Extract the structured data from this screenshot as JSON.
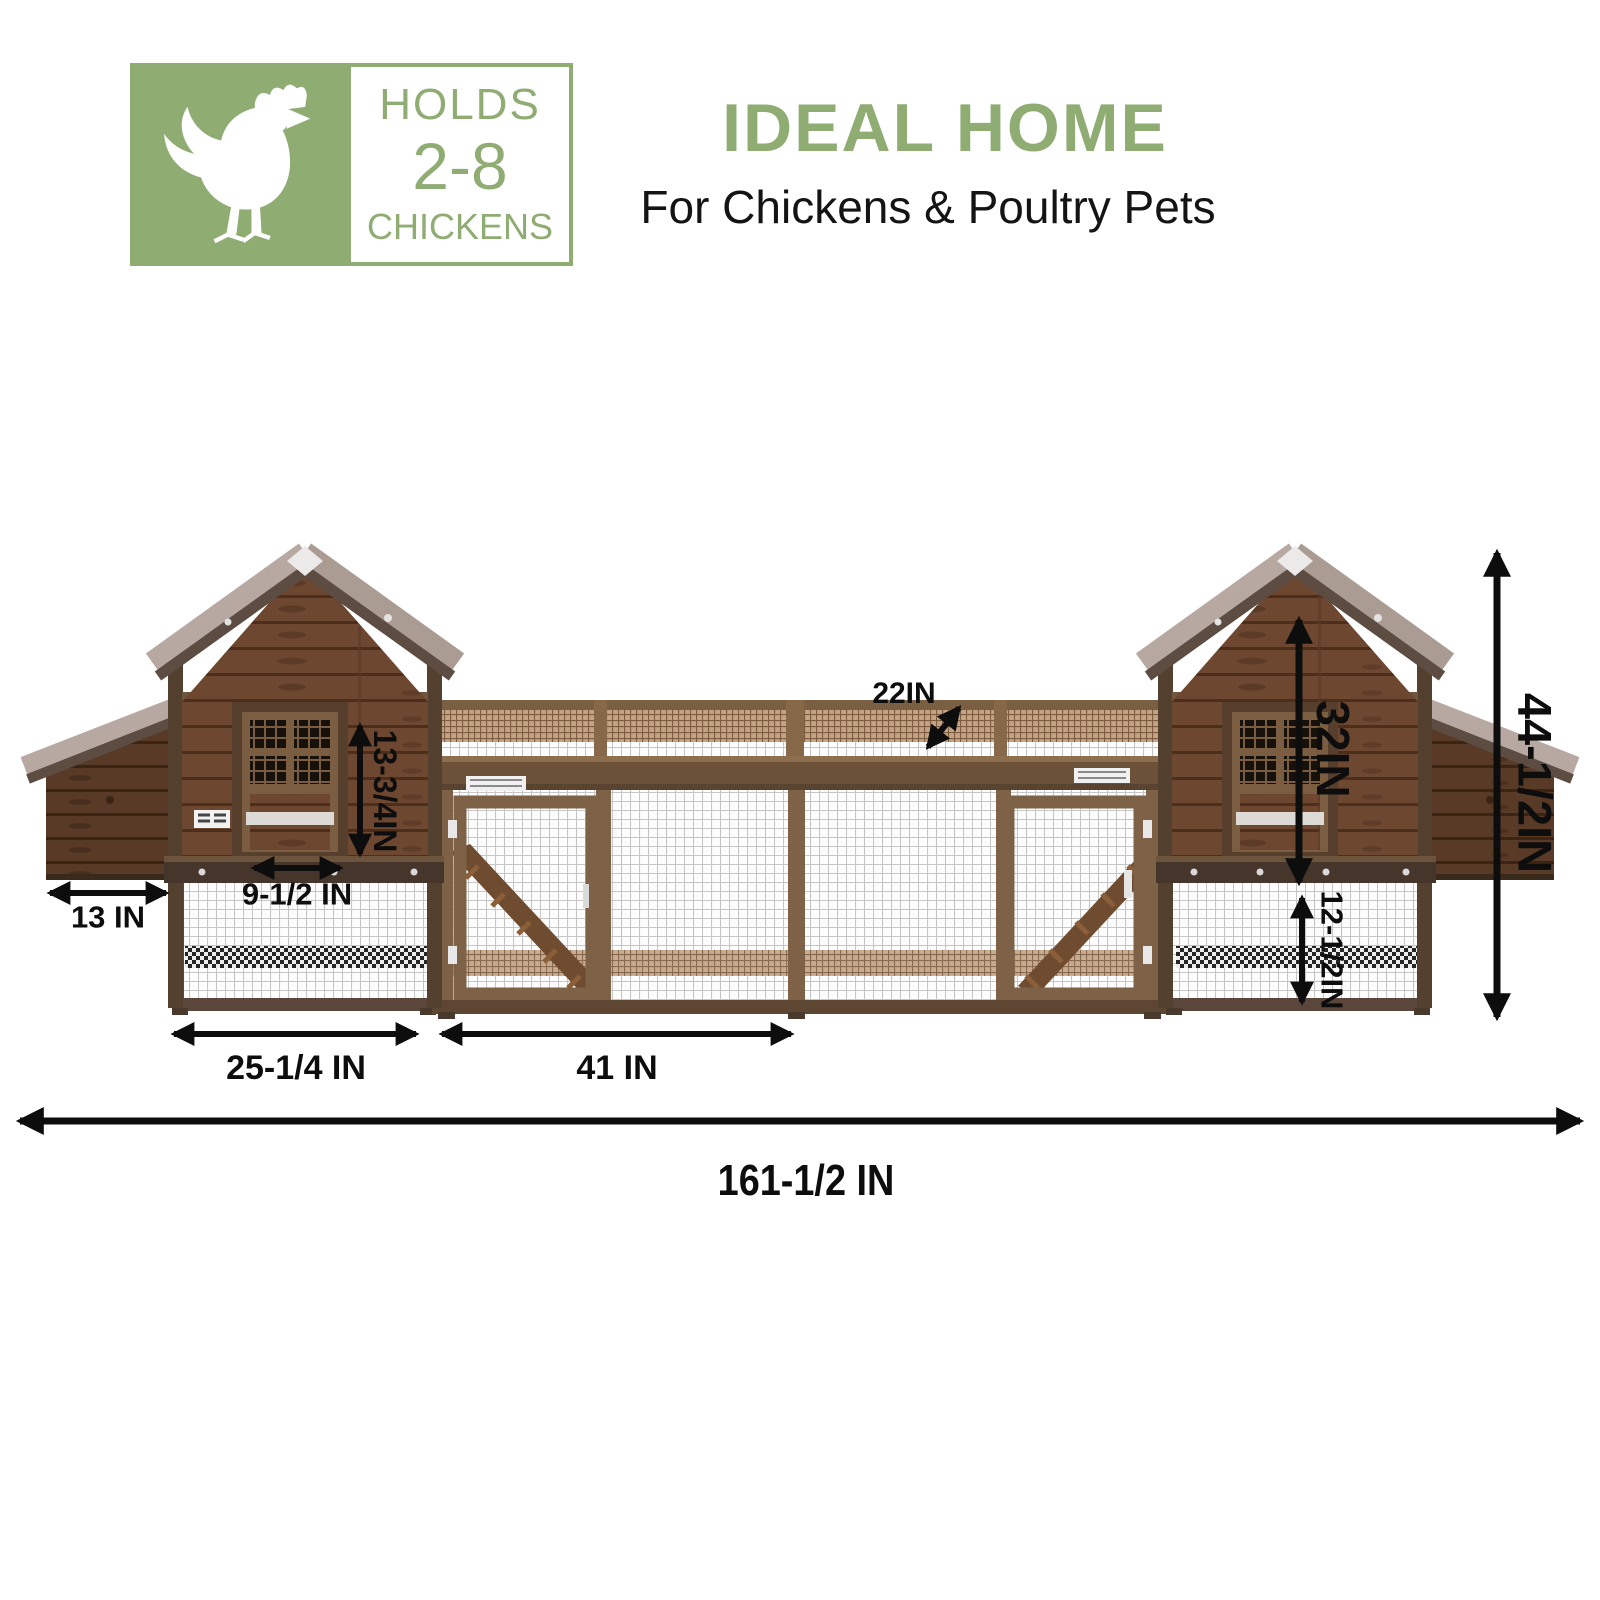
{
  "badge": {
    "icon": "chicken",
    "holds_label": "HOLDS",
    "capacity": "2-8",
    "chickens_label": "CHICKENS"
  },
  "header": {
    "title": "IDEAL HOME",
    "subtitle": "For Chickens & Poultry Pets"
  },
  "dimensions": {
    "nest_box_depth": "13 IN",
    "window_width": "9-1/2 IN",
    "window_height": "13-3/4IN",
    "run_top_width": "22IN",
    "house_height": "32IN",
    "lower_run_height": "12-1/2IN",
    "total_height": "44-1/2IN",
    "left_section_width": "25-1/4 IN",
    "center_run_width": "41 IN",
    "total_width": "161-1/2 IN"
  },
  "colors": {
    "accent_green": "#8fac73",
    "dimension_black": "#0d0d0d",
    "wood_brown": "#6d4730",
    "dark_wood": "#593a26",
    "frame_brown": "#7d6248",
    "roof_taupe": "#b7a9a2"
  }
}
